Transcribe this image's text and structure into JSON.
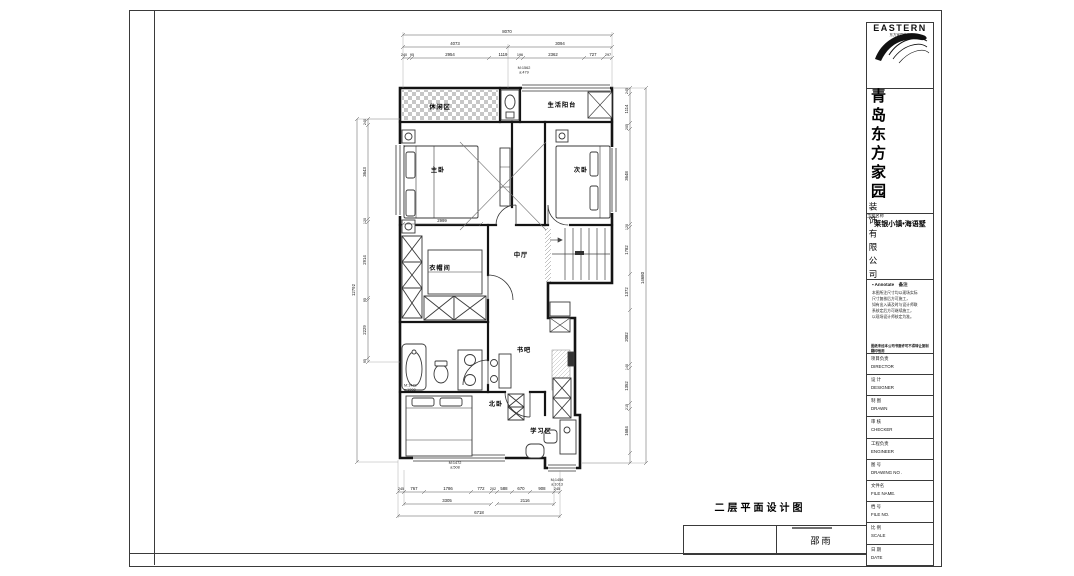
{
  "sheet": {
    "drawing_title": "二层平面设计图",
    "stamp_name": "邵雨"
  },
  "title_block": {
    "brand": "EASTERN",
    "brand_sub": "东方家园装饰",
    "company_main": "青岛东方家园",
    "company_sub": "装饰有限公司",
    "project_label": "工程名称",
    "project_name": "莱银小镇•海语墅",
    "annotate": {
      "header": "▪ Annotate　备注",
      "notes": [
        "本图所注尺寸均以现场实际",
        "尺寸复核后方可施工，",
        "如有出入请及时与设计师联",
        "系核定后方可继续施工，",
        "以现场设计师核定为准。"
      ],
      "footer": "图纸未经本公司书面许可不得转让复制翻印他用"
    },
    "rows": [
      {
        "cn": "项目负责",
        "en": "DIRECTOR"
      },
      {
        "cn": "设 计",
        "en": "DESIGNER"
      },
      {
        "cn": "制 图",
        "en": "DRAWN"
      },
      {
        "cn": "审 核",
        "en": "CHECKER"
      },
      {
        "cn": "工程负责",
        "en": "ENGINEER"
      },
      {
        "cn": "图  号",
        "en": "DRAWING NO ."
      },
      {
        "cn": "文件名",
        "en": "FILE NAME."
      },
      {
        "cn": "档  号",
        "en": "FILE NO."
      },
      {
        "cn": "比  例",
        "en": "SCALE"
      },
      {
        "cn": "日  期",
        "en": "DATE"
      }
    ]
  },
  "plan": {
    "rooms": {
      "leisure": "休闲区",
      "balcony": "生活阳台",
      "master": "主卧",
      "second": "次卧",
      "hall": "中厅",
      "cloak": "衣帽间",
      "bookbar": "书吧",
      "north": "北卧",
      "study": "学习区"
    },
    "dims": {
      "top_total": "8070",
      "top_mid": [
        "4073",
        "3094"
      ],
      "top_inner": [
        "240",
        "95",
        "2954",
        "1119",
        "196",
        "2362",
        "727",
        "297"
      ],
      "left_total": "12792",
      "left_inner": [
        "240",
        "3643",
        "120",
        "2914",
        "95",
        "2229",
        "95"
      ],
      "right_total": "14680",
      "right_inner": [
        "245",
        "1114",
        "205",
        "3648",
        "120",
        "1782",
        "1372",
        "2082",
        "140",
        "1352",
        "215",
        "1684"
      ],
      "bottom_inner": [
        "245",
        "767",
        "1786",
        "772",
        "202",
        "588",
        "670",
        "908",
        "245"
      ],
      "bottom_mid": [
        "3305",
        "2116"
      ],
      "bottom_total": "6718",
      "inner_cloak": "2999"
    },
    "tags": {
      "t1": [
        "M:1562",
        "a:479"
      ],
      "t2": [
        "M:1472",
        "a:1008"
      ],
      "t3": [
        "M:1472",
        "a:508"
      ],
      "t4": [
        "M:1456",
        "a:1013"
      ]
    }
  }
}
